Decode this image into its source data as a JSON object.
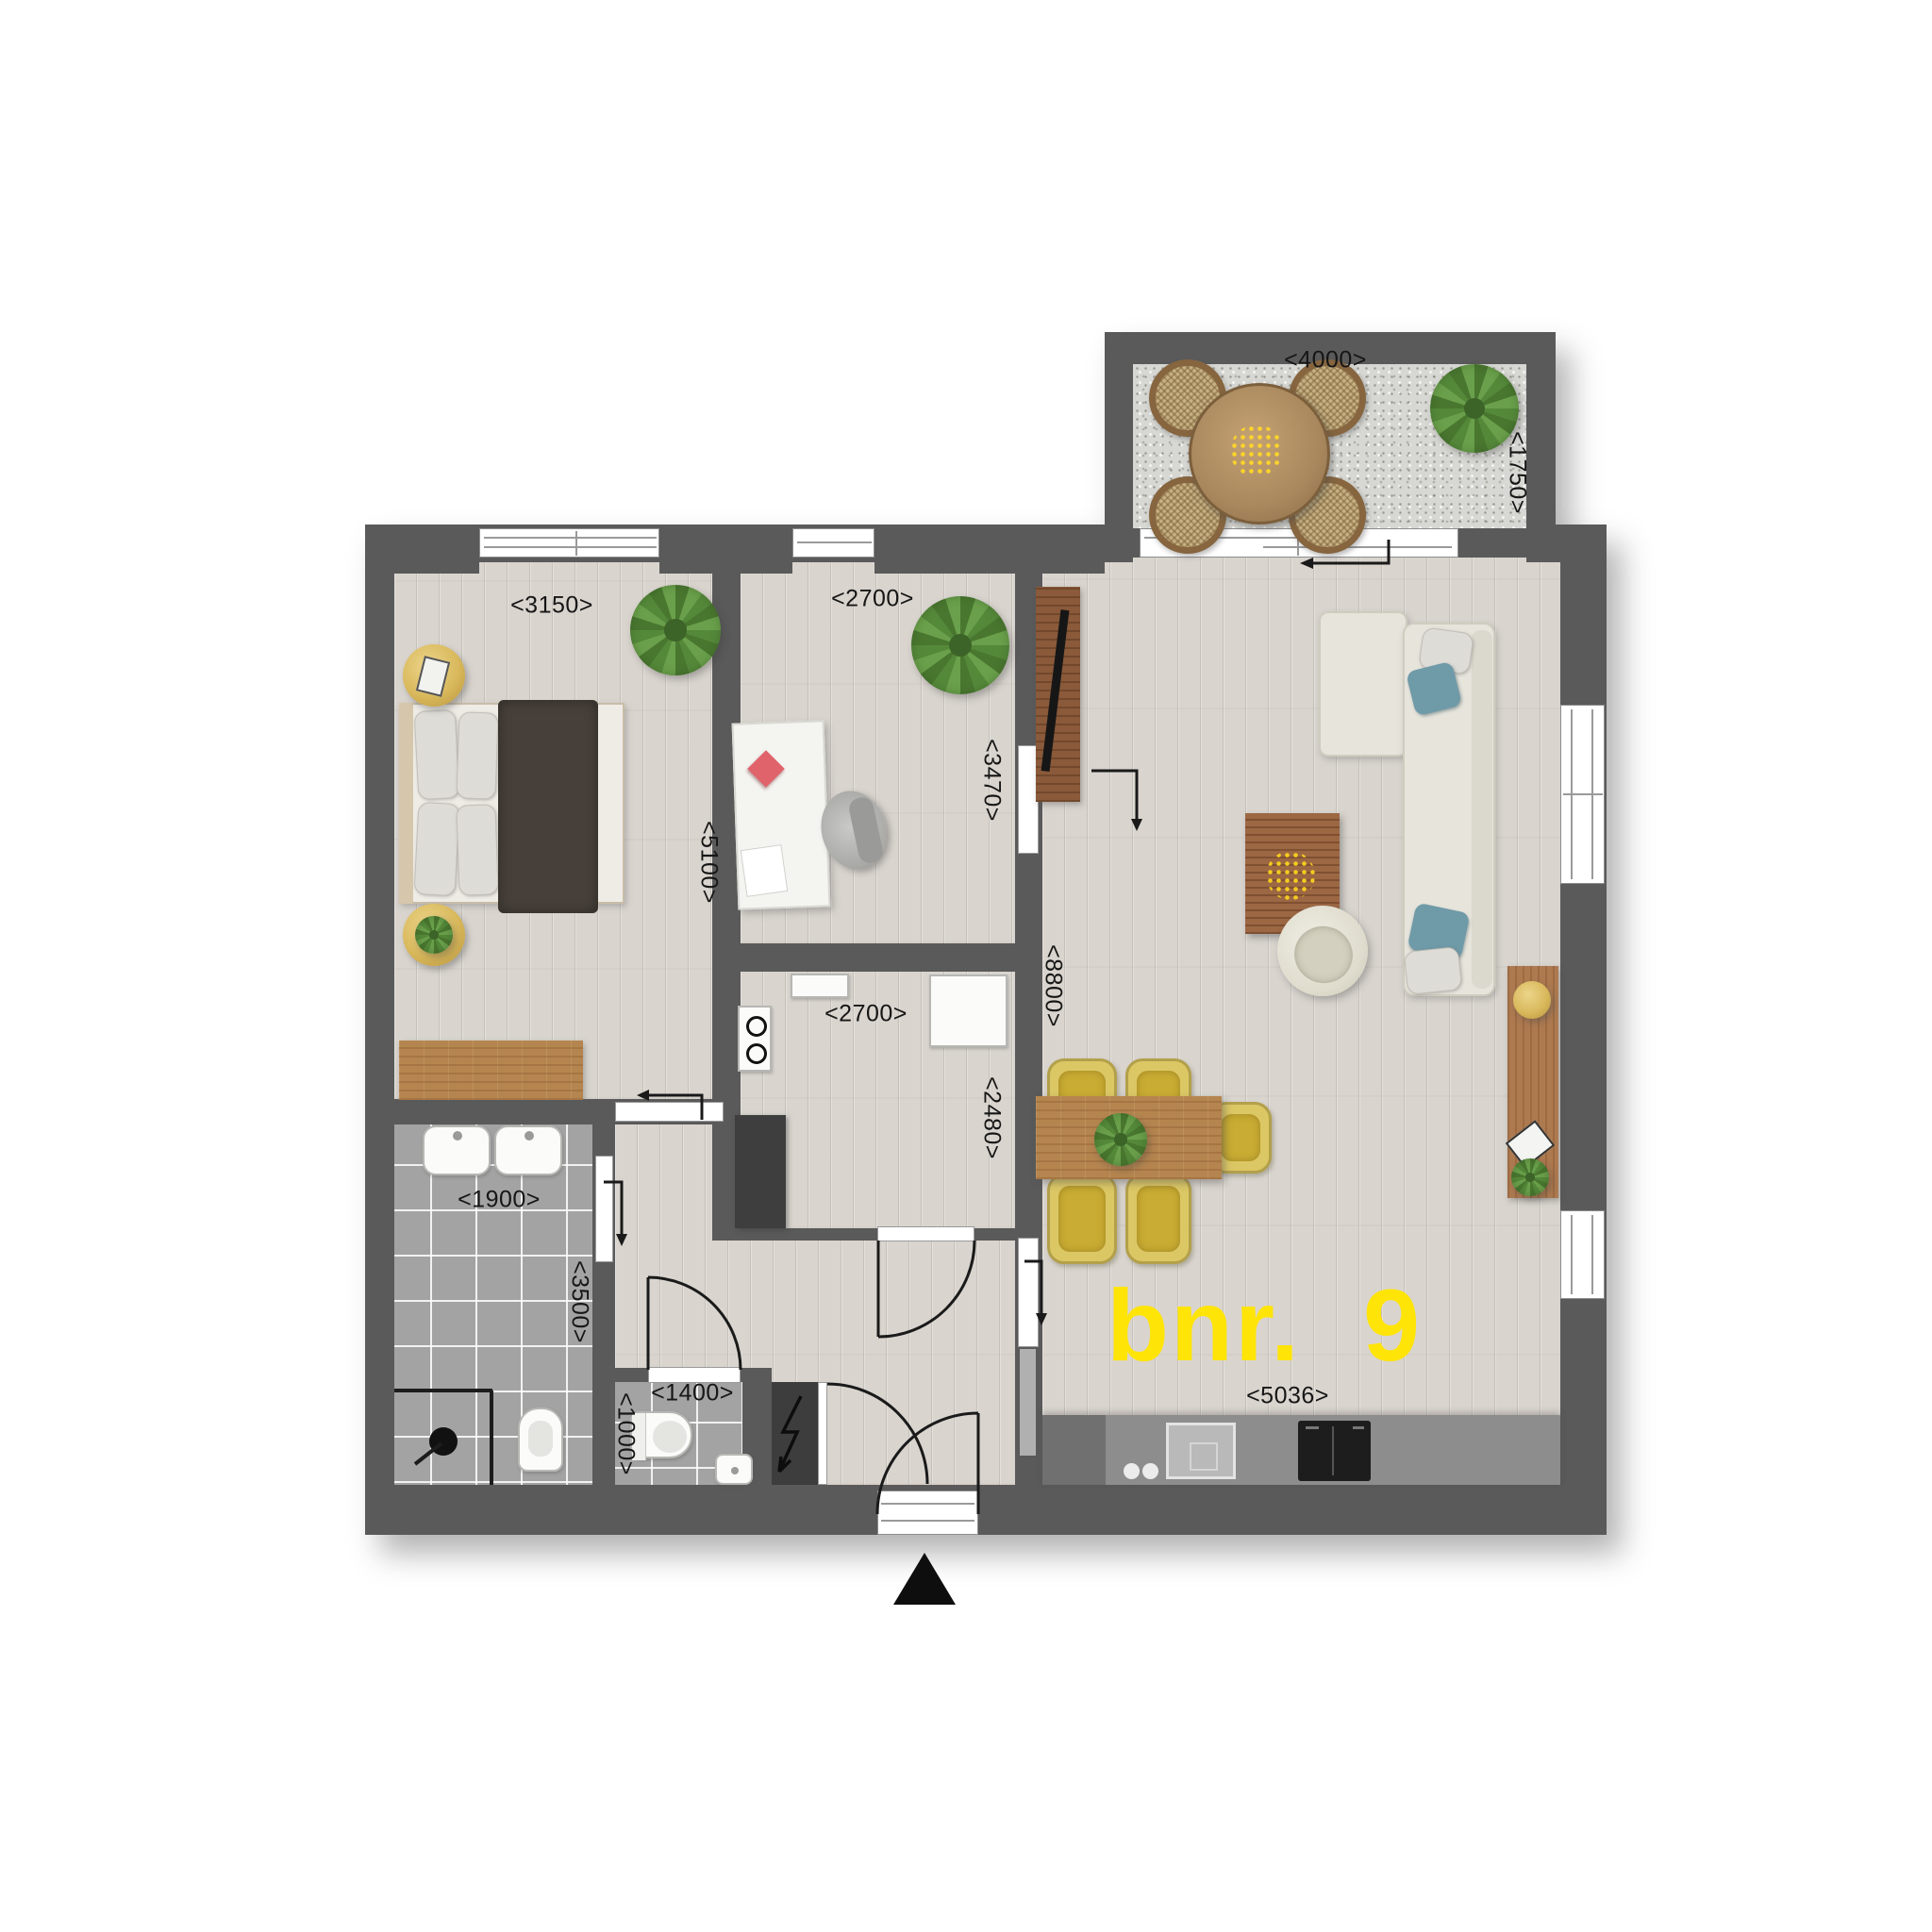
{
  "plan": {
    "unit_label": {
      "text": "bnr. 9",
      "color": "#ffe408"
    },
    "north_arrow": {
      "symbol": "▲"
    },
    "dimension_labels": {
      "terrace_width": {
        "text": "<4000>",
        "orientation": "horizontal"
      },
      "terrace_depth": {
        "text": "<1750>",
        "orientation": "vertical"
      },
      "bedroom_width": {
        "text": "<3150>",
        "orientation": "horizontal"
      },
      "bedroom_depth": {
        "text": "<5100>",
        "orientation": "vertical"
      },
      "study_width": {
        "text": "<2700>",
        "orientation": "horizontal"
      },
      "study_opening": {
        "text": "<3470>",
        "orientation": "vertical"
      },
      "kitchen_width": {
        "text": "<2700>",
        "orientation": "horizontal"
      },
      "kitchen_depth": {
        "text": "<2480>",
        "orientation": "vertical"
      },
      "living_depth": {
        "text": "<8800>",
        "orientation": "vertical"
      },
      "living_width": {
        "text": "<5036>",
        "orientation": "horizontal"
      },
      "bathroom_width": {
        "text": "<1900>",
        "orientation": "horizontal"
      },
      "bathroom_depth": {
        "text": "<3500>",
        "orientation": "vertical"
      },
      "wc_width": {
        "text": "<1400>",
        "orientation": "horizontal"
      },
      "wc_depth": {
        "text": "<1000>",
        "orientation": "vertical"
      }
    },
    "colors": {
      "wall": "#5a5a5a",
      "wall_dark": "#3d3d3d",
      "floor": "#d9d4ce",
      "tile": "#a3a3a3",
      "gravel": "#d7d7d3",
      "accent_yellow": "#ffe408",
      "wood": "#b5854f",
      "sofa": "#e6e4db",
      "chair_yellow": "#dcc765"
    }
  }
}
